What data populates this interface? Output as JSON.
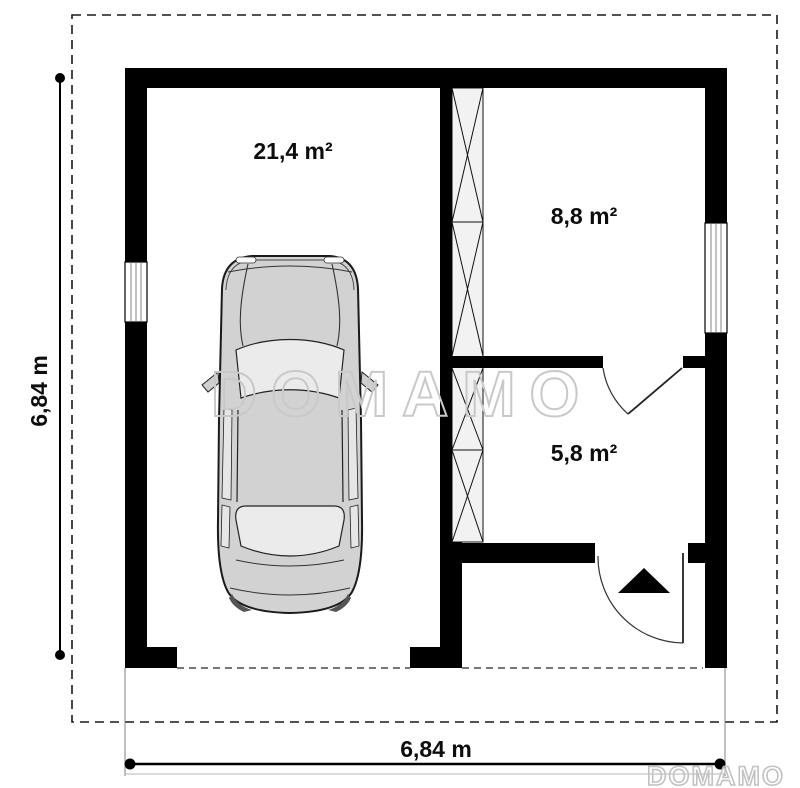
{
  "plan": {
    "rooms": [
      {
        "name": "garage",
        "area_label": "21,4 m²"
      },
      {
        "name": "upper-room",
        "area_label": "8,8 m²"
      },
      {
        "name": "lower-room",
        "area_label": "5,8 m²"
      }
    ],
    "dimensions": {
      "overall_width": "6,84 m",
      "overall_height": "6,84 m"
    }
  },
  "watermark": {
    "center": "DOMAMO",
    "corner": "DOMAMO"
  },
  "colors": {
    "wall": "#000000",
    "hatch_fill": "#f2f2f2",
    "car_body": "#d2d2d2",
    "glass": "#ebebeb",
    "watermark_stroke": "#c9c9c9",
    "dimension_line": "#000000",
    "extension_line": "#808080"
  }
}
